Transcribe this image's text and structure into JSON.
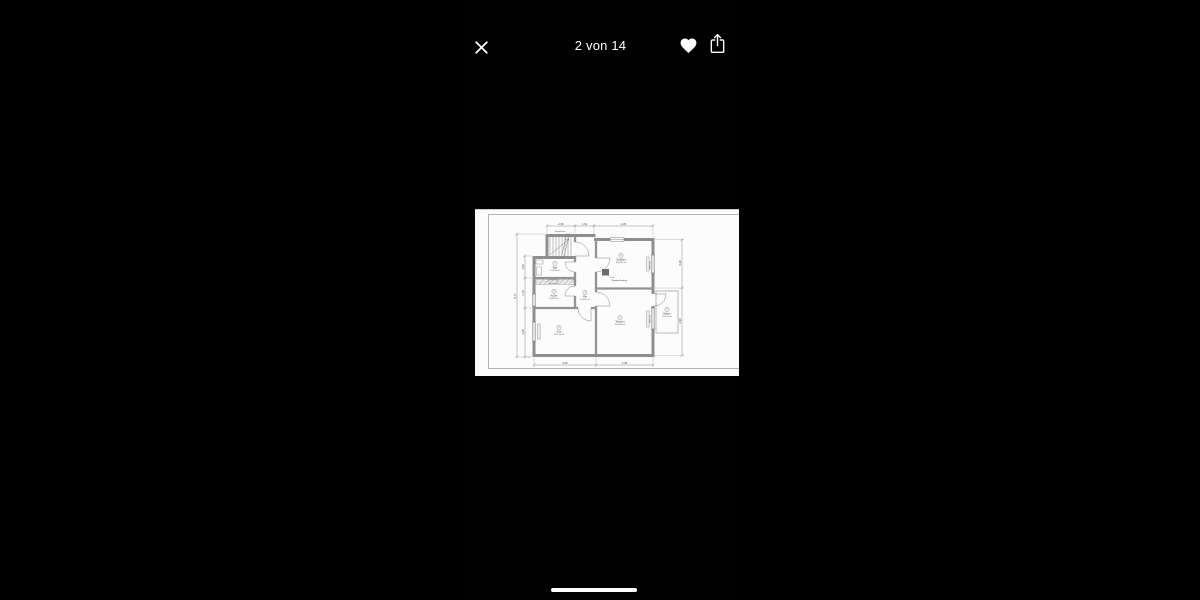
{
  "viewer": {
    "counter": "2 von 14"
  },
  "icons": {
    "close": "✕",
    "favorite": "♥",
    "share": "↑"
  },
  "colors": {
    "background": "#000000",
    "icon_white": "#ffffff",
    "sheet_white": "#fcfcfd",
    "plan_wall_gray": "#8e8e90"
  },
  "floorplan": {
    "stair_label": "Treppenhaus",
    "annotation": [
      "mit",
      "Wandverkleidung"
    ],
    "rooms": [
      {
        "num": "1",
        "name": "Bad",
        "area": "F=4,58 m²"
      },
      {
        "num": "2",
        "name": "Küche",
        "area": "F=8,32 m²"
      },
      {
        "num": "3",
        "name": "Flur",
        "area": "F=6,05 m²"
      },
      {
        "num": "4",
        "name": "Schlafen",
        "area": "F=14,12 m²"
      },
      {
        "num": "5",
        "name": "Wohnen",
        "area": "F=18,26 m²"
      },
      {
        "num": "6",
        "name": "Kind",
        "area": "F=11,24 m²"
      },
      {
        "num": "7",
        "name": "Balkon",
        "area": "F=3,12 m²"
      }
    ],
    "dims": {
      "top": [
        "2,39",
        "1,64",
        "4,05"
      ],
      "bottom": [
        "5,40",
        "4,05"
      ],
      "left": [
        "1,40",
        "2,10",
        "3,45",
        "8,77"
      ],
      "right": [
        "4,38",
        "2,96"
      ],
      "brh": [
        "BRH 0,91",
        "BRH 0,91"
      ]
    }
  }
}
